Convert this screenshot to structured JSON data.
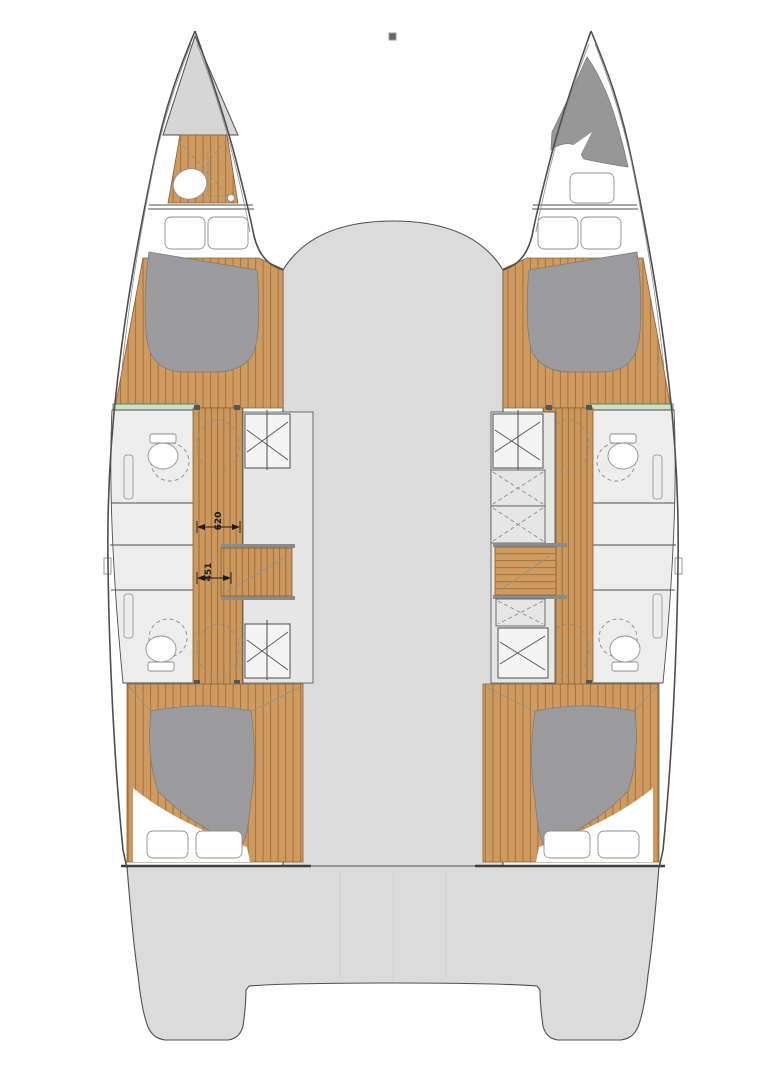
{
  "annotations": {
    "dimensions": [
      {
        "value": "620"
      },
      {
        "value": "451"
      }
    ]
  },
  "marker": {
    "shape": "small-square"
  },
  "colors": {
    "deck": "#DBDBDB",
    "bow_deck": "#D6D6D7",
    "wood": "#CF9A5F",
    "wood_line": "#A0743F",
    "bed": "#9B9B9D",
    "berth": "#979797",
    "panel": "#E6E6E6",
    "heads": "#EDEDEE",
    "outline": "#4F4F4F",
    "line_light": "#909090",
    "green_fill": "#CFE0CA",
    "green_line": "#5F8456",
    "dim_text": "#1A1A1A"
  }
}
